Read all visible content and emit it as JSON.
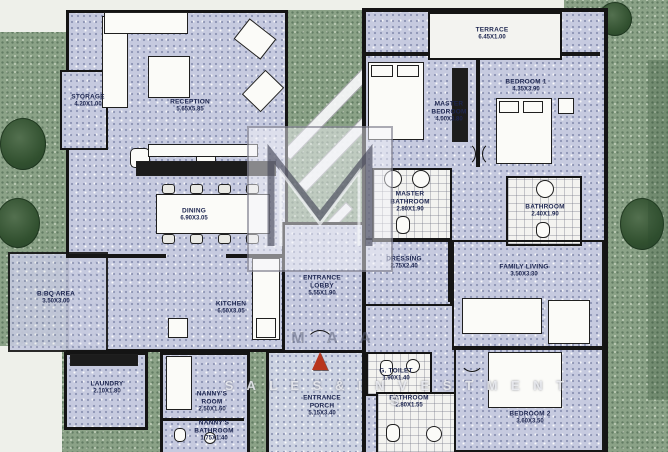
{
  "plan": {
    "type": "apartment-floor-plan-scan",
    "colors": {
      "landscape_green": "#8ba287",
      "floor_lavender": "#c6cadf",
      "wall_black": "#141414",
      "tile_white": "#f3f3f0",
      "label_navy": "#1d2650",
      "north_arrow_red": "#b8351d"
    },
    "watermark": {
      "row1": "M A A",
      "row2": "S A L E S  &  I N V E S T M E N T S"
    },
    "rooms": [
      {
        "id": "storage",
        "name": "STORAGE",
        "dims": "4.20X1.00",
        "x": 88,
        "y": 101,
        "w": 40
      },
      {
        "id": "reception",
        "name": "RECEPTION",
        "dims": "5.65X5.85",
        "x": 190,
        "y": 106,
        "w": 60
      },
      {
        "id": "dining",
        "name": "DINING",
        "dims": "6.90X3.05",
        "x": 194,
        "y": 215,
        "w": 60
      },
      {
        "id": "bbq-area",
        "name": "B.BQ AREA",
        "dims": "3.50X3.00",
        "x": 56,
        "y": 298,
        "w": 60
      },
      {
        "id": "kitchen",
        "name": "KITCHEN",
        "dims": "6.50X3.05",
        "x": 231,
        "y": 308,
        "w": 60
      },
      {
        "id": "entrance-lobby",
        "name": "ENTRANCE LOBBY",
        "dims": "5.55X1.90",
        "x": 322,
        "y": 286,
        "w": 46
      },
      {
        "id": "master-bedroom",
        "name": "MASTER BEDROOM",
        "dims": "4.00X3.80",
        "x": 449,
        "y": 112,
        "w": 42
      },
      {
        "id": "bedroom-1",
        "name": "BEDROOM 1",
        "dims": "4.35X3.90",
        "x": 526,
        "y": 86,
        "w": 60
      },
      {
        "id": "master-bathroom",
        "name": "MASTER BATHROOM",
        "dims": "2.80X1.90",
        "x": 410,
        "y": 202,
        "w": 46
      },
      {
        "id": "bathroom-upper",
        "name": "BATHROOM",
        "dims": "2.40X1.90",
        "x": 545,
        "y": 211,
        "w": 44
      },
      {
        "id": "dressing",
        "name": "DRESSING",
        "dims": "2.75X2.40",
        "x": 404,
        "y": 263,
        "w": 50
      },
      {
        "id": "family-living",
        "name": "FAMILY LIVING",
        "dims": "3.50X3.30",
        "x": 524,
        "y": 271,
        "w": 60
      },
      {
        "id": "laundry",
        "name": "LAUNDRY",
        "dims": "2.10X1.80",
        "x": 107,
        "y": 388,
        "w": 46
      },
      {
        "id": "nannys-room",
        "name": "NANNY'S ROOM",
        "dims": "2.50X1.60",
        "x": 212,
        "y": 402,
        "w": 44
      },
      {
        "id": "nannys-bathroom",
        "name": "NANNY'S BATHROOM",
        "dims": "1.75X1.40",
        "x": 214,
        "y": 431,
        "w": 46
      },
      {
        "id": "entrance-porch",
        "name": "ENTRANCE PORCH",
        "dims": "5.15X3.40",
        "x": 322,
        "y": 406,
        "w": 46
      },
      {
        "id": "g-toilet",
        "name": "G. TOILET",
        "dims": "1.90X1.40",
        "x": 396,
        "y": 375,
        "w": 44
      },
      {
        "id": "bathroom-lower",
        "name": "BATHROOM",
        "dims": "2.80X1.55",
        "x": 409,
        "y": 402,
        "w": 46
      },
      {
        "id": "bedroom-2",
        "name": "BEDROOM 2",
        "dims": "3.60X3.50",
        "x": 530,
        "y": 418,
        "w": 60
      },
      {
        "id": "terrace",
        "name": "TERRACE",
        "dims": "6.45X1.00",
        "x": 492,
        "y": 34,
        "w": 70
      }
    ]
  }
}
